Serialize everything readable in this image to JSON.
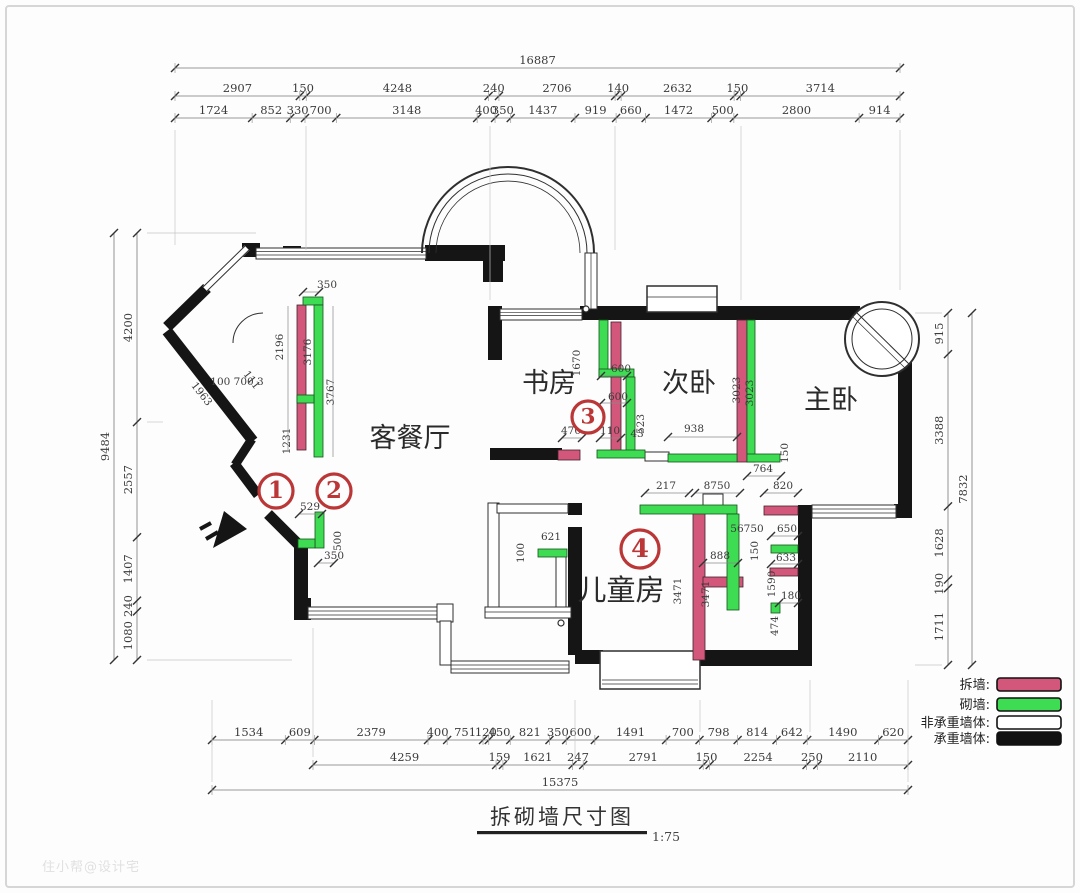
{
  "meta": {
    "title": "拆砌墙尺寸图",
    "scale_label": "1:75",
    "watermark": "住小帮@设计宅"
  },
  "rooms": {
    "living": "客餐厅",
    "study": "书房",
    "second_bedroom": "次卧",
    "master_bedroom": "主卧",
    "kids_room": "儿童房"
  },
  "markers": [
    "1",
    "2",
    "3",
    "4"
  ],
  "legend": {
    "items": [
      {
        "name": "demolish-wall",
        "label": "拆墙:",
        "color": "#d2577b"
      },
      {
        "name": "build-wall",
        "label": "砌墙:",
        "color": "#3edc52"
      },
      {
        "name": "non-load-bearing-wall",
        "label": "非承重墙体:",
        "color": "#ffffff"
      },
      {
        "name": "load-bearing-wall",
        "label": "承重墙体:",
        "color": "#111111"
      }
    ]
  },
  "colors": {
    "demolish": "#d2577b",
    "build": "#3edc52",
    "load_bearing": "#151515",
    "marker_red": "#bb3636",
    "dim_text": "#3b3b3b"
  },
  "dimensions": {
    "top": {
      "total": "16887",
      "row2": [
        "2907",
        "150",
        "4248",
        "240",
        "2706",
        "140",
        "2632",
        "150",
        "3714"
      ],
      "row3": [
        "1724",
        "852",
        "330",
        "700",
        "3148",
        "400",
        "350",
        "1437",
        "919",
        "660",
        "1472",
        "500",
        "2800",
        "914"
      ]
    },
    "bottom": {
      "row1": [
        "1534",
        "609",
        "2379",
        "400",
        "751",
        "120",
        "450",
        "821",
        "350",
        "600",
        "1491",
        "700",
        "798",
        "814",
        "642",
        "1490",
        "620"
      ],
      "row2": [
        "4259",
        "159",
        "1621",
        "247",
        "2791",
        "150",
        "2254",
        "250",
        "2110"
      ],
      "total": "15375"
    },
    "left": {
      "total": "9484",
      "segments": [
        "4200",
        "2557",
        "1407",
        "240",
        "1080"
      ]
    },
    "right": {
      "total": "7832",
      "segments": [
        "915",
        "3388",
        "1628",
        "190",
        "1711"
      ]
    },
    "interior": [
      "350",
      "2196",
      "3176",
      "3767",
      "1231",
      "111",
      "1963",
      "100 700 3",
      "529",
      "500",
      "350",
      "1670",
      "600",
      "600",
      "523",
      "43",
      "470",
      "110",
      "938",
      "3023",
      "3023",
      "764",
      "150",
      "217",
      "8750",
      "820",
      "56750",
      "650",
      "150",
      "888",
      "633",
      "1590",
      "180",
      "474",
      "3471",
      "3471",
      "621",
      "100"
    ]
  }
}
